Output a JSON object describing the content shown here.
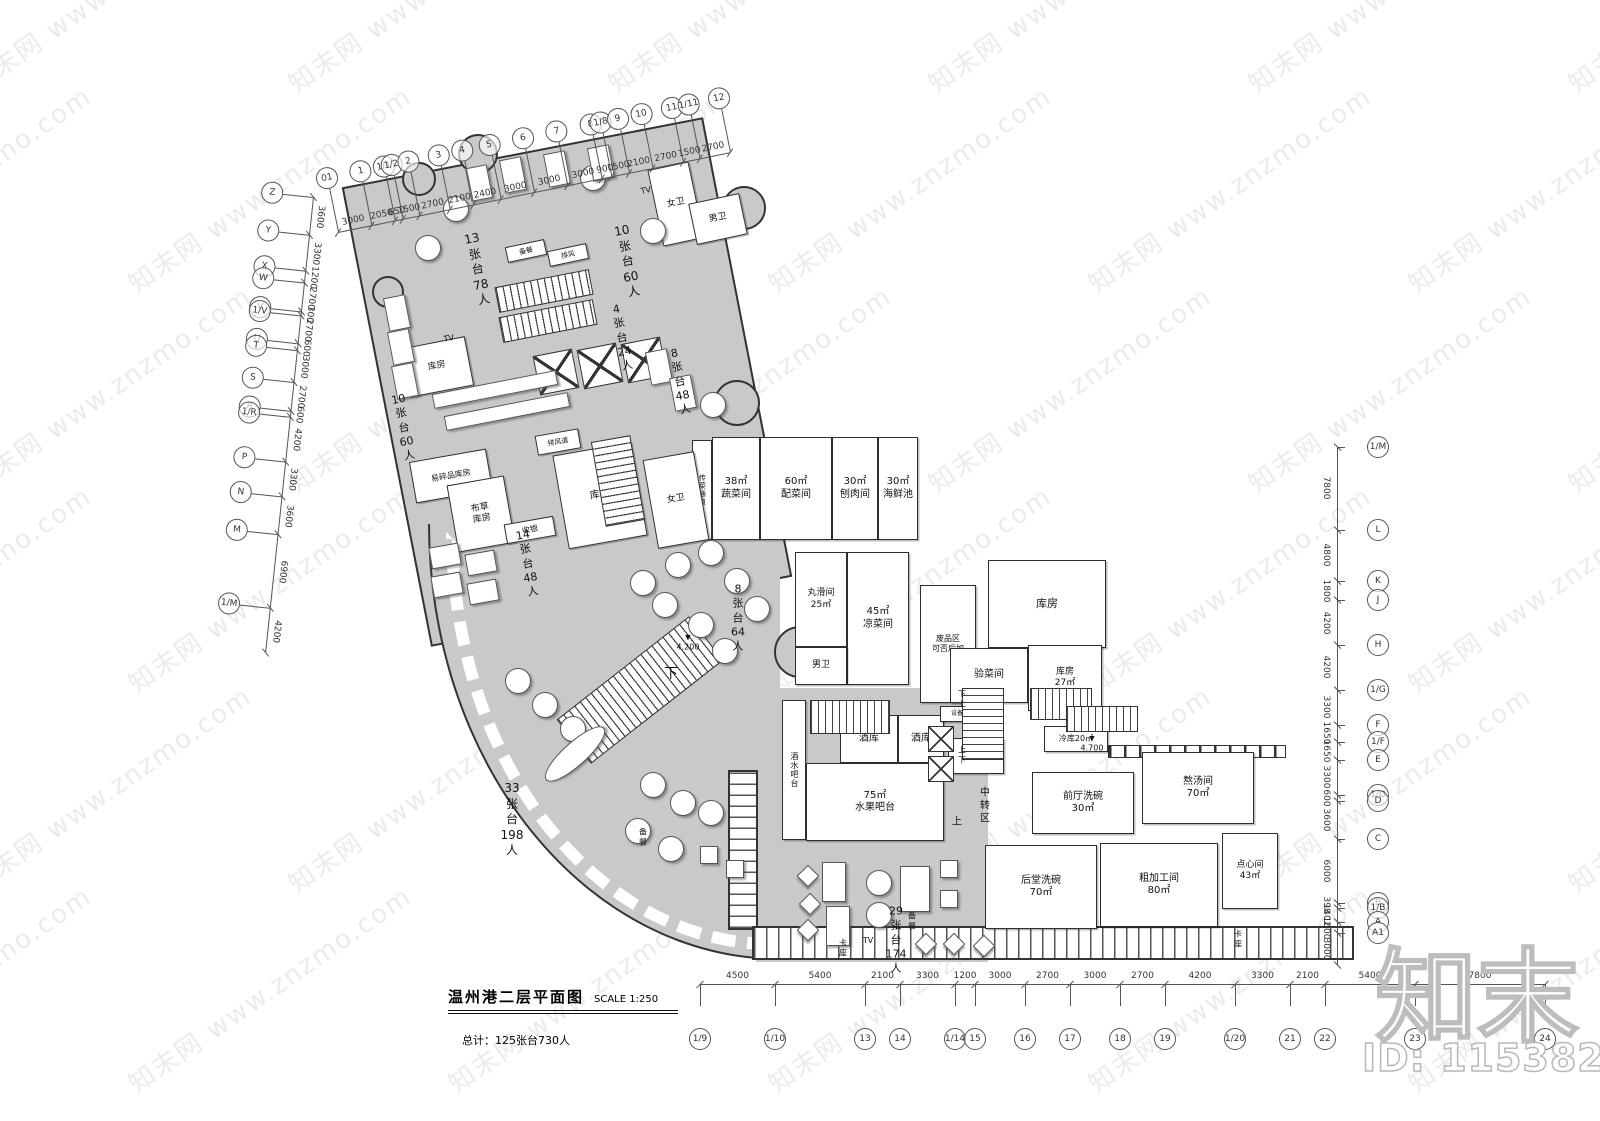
{
  "document": {
    "title": "温州港二层平面图",
    "scale": "SCALE 1:250",
    "total": "总计：125张台730人"
  },
  "brand": {
    "logo": "知末",
    "id_label": "ID: 1153825906",
    "watermark": "知末网 www.znzmo.com"
  },
  "colors": {
    "floor": "#c9c9c9",
    "wall": "#2e2e2e",
    "annotation": "#555555"
  },
  "plan": {
    "rooms": [
      {
        "n": "food-pass-corridor",
        "x": 692,
        "y": 440,
        "w": 20,
        "h": 100,
        "label": "传菜通道",
        "fs": 7,
        "vert": true
      },
      {
        "n": "vegetable-room",
        "x": 712,
        "y": 437,
        "w": 48,
        "h": 103,
        "label": "38㎡\n蔬菜间",
        "fs": 10
      },
      {
        "n": "garnish-room",
        "x": 760,
        "y": 437,
        "w": 72,
        "h": 103,
        "label": "60㎡\n配菜间",
        "fs": 10
      },
      {
        "n": "meat-slicing-room",
        "x": 832,
        "y": 437,
        "w": 46,
        "h": 103,
        "label": "30㎡\n刨肉间",
        "fs": 10
      },
      {
        "n": "seafood-pool",
        "x": 878,
        "y": 437,
        "w": 40,
        "h": 103,
        "label": "30㎡\n海鲜池",
        "fs": 10
      },
      {
        "n": "meatball-room",
        "x": 795,
        "y": 552,
        "w": 52,
        "h": 95,
        "label": "丸滑间\n25㎡",
        "fs": 9
      },
      {
        "n": "cold-dish-room",
        "x": 847,
        "y": 552,
        "w": 62,
        "h": 133,
        "label": "45㎡\n凉菜间",
        "fs": 10
      },
      {
        "n": "mens-toilet-kitchen",
        "x": 795,
        "y": 647,
        "w": 52,
        "h": 38,
        "label": "男卫",
        "fs": 9
      },
      {
        "n": "waste-area",
        "x": 920,
        "y": 585,
        "w": 56,
        "h": 118,
        "label": "废品区\n可否后加",
        "fs": 8
      },
      {
        "n": "storage-upper-right",
        "x": 988,
        "y": 560,
        "w": 118,
        "h": 88,
        "label": "库房",
        "fs": 11
      },
      {
        "n": "goods-check-room",
        "x": 950,
        "y": 648,
        "w": 78,
        "h": 55,
        "label": "验菜间",
        "fs": 10
      },
      {
        "n": "storage-27",
        "x": 1028,
        "y": 645,
        "w": 74,
        "h": 66,
        "label": "库房\n27㎡",
        "fs": 9
      },
      {
        "n": "drinks-bar",
        "x": 782,
        "y": 700,
        "w": 24,
        "h": 140,
        "label": "酒水吧台",
        "fs": 8,
        "vert": true
      },
      {
        "n": "wine-store-1",
        "x": 840,
        "y": 715,
        "w": 58,
        "h": 48,
        "label": "酒库",
        "fs": 10
      },
      {
        "n": "wine-store-2",
        "x": 898,
        "y": 715,
        "w": 46,
        "h": 48,
        "label": "酒库",
        "fs": 10
      },
      {
        "n": "fruit-bar",
        "x": 806,
        "y": 763,
        "w": 138,
        "h": 78,
        "label": "75㎡\n水果吧台",
        "fs": 10
      },
      {
        "n": "engineering-dept",
        "x": 948,
        "y": 738,
        "w": 56,
        "h": 36,
        "label": "工程部",
        "fs": 9
      },
      {
        "n": "equipment-shaft",
        "x": 940,
        "y": 706,
        "w": 52,
        "h": 16,
        "label": "设备管道井",
        "fs": 6
      },
      {
        "n": "cold-store",
        "x": 1044,
        "y": 726,
        "w": 64,
        "h": 26,
        "label": "冷库20㎡",
        "fs": 8
      },
      {
        "n": "front-dishwash",
        "x": 1032,
        "y": 772,
        "w": 102,
        "h": 62,
        "label": "前厅洗碗\n30㎡",
        "fs": 10
      },
      {
        "n": "soup-room",
        "x": 1142,
        "y": 752,
        "w": 112,
        "h": 72,
        "label": "熬汤间\n70㎡",
        "fs": 10
      },
      {
        "n": "back-dishwash",
        "x": 985,
        "y": 845,
        "w": 112,
        "h": 84,
        "label": "后堂洗碗\n70㎡",
        "fs": 10
      },
      {
        "n": "rough-processing",
        "x": 1100,
        "y": 843,
        "w": 118,
        "h": 84,
        "label": "粗加工间\n80㎡",
        "fs": 10
      },
      {
        "n": "pastry-room",
        "x": 1222,
        "y": 833,
        "w": 56,
        "h": 76,
        "label": "点心间\n43㎡",
        "fs": 9
      },
      {
        "n": "storage-upper-left",
        "x": 404,
        "y": 342,
        "w": 66,
        "h": 50,
        "label": "库房",
        "fs": 9,
        "rot": -11
      },
      {
        "n": "fragile-storage",
        "x": 412,
        "y": 455,
        "w": 78,
        "h": 42,
        "label": "易碎品库房",
        "fs": 8,
        "rot": -10
      },
      {
        "n": "linen-storage",
        "x": 452,
        "y": 480,
        "w": 58,
        "h": 68,
        "label": "布草\n库房",
        "fs": 9,
        "rot": -10
      },
      {
        "n": "exhaust-duct",
        "x": 536,
        "y": 432,
        "w": 44,
        "h": 20,
        "label": "排风道",
        "fs": 7,
        "rot": -10
      },
      {
        "n": "storage-center",
        "x": 560,
        "y": 448,
        "w": 80,
        "h": 95,
        "label": "库房",
        "fs": 10,
        "rot": -10
      },
      {
        "n": "womens-toilet-center",
        "x": 650,
        "y": 455,
        "w": 52,
        "h": 90,
        "label": "女卫",
        "fs": 9,
        "rot": -10
      },
      {
        "n": "womens-toilet-top",
        "x": 655,
        "y": 165,
        "w": 42,
        "h": 78,
        "label": "女卫",
        "fs": 9,
        "rot": -12
      },
      {
        "n": "mens-toilet-top",
        "x": 692,
        "y": 198,
        "w": 52,
        "h": 42,
        "label": "男卫",
        "fs": 9,
        "rot": -12
      },
      {
        "n": "cashier",
        "x": 505,
        "y": 520,
        "w": 50,
        "h": 20,
        "label": "收银",
        "fs": 8,
        "rot": -10
      },
      {
        "n": "pantry-top",
        "x": 506,
        "y": 243,
        "w": 40,
        "h": 16,
        "label": "备餐",
        "fs": 7,
        "rot": -12
      },
      {
        "n": "vent-top",
        "x": 548,
        "y": 247,
        "w": 40,
        "h": 16,
        "label": "排风",
        "fs": 7,
        "rot": -12
      }
    ],
    "labels": [
      {
        "x": 478,
        "y": 270,
        "t": "13张台\n78人",
        "fs": 12,
        "r": -11
      },
      {
        "x": 628,
        "y": 262,
        "t": "10张台\n60人",
        "fs": 12,
        "r": -11
      },
      {
        "x": 622,
        "y": 338,
        "t": "4张台\n24人",
        "fs": 11,
        "r": -11
      },
      {
        "x": 680,
        "y": 382,
        "t": "8张台\n48人",
        "fs": 11,
        "r": -11
      },
      {
        "x": 404,
        "y": 428,
        "t": "10张台\n60人",
        "fs": 11,
        "r": -11
      },
      {
        "x": 528,
        "y": 564,
        "t": "14张台\n48人",
        "fs": 11,
        "r": -10
      },
      {
        "x": 738,
        "y": 618,
        "t": "8张台\n64人",
        "fs": 11
      },
      {
        "x": 512,
        "y": 820,
        "t": "33张台\n198人",
        "fs": 12
      },
      {
        "x": 896,
        "y": 940,
        "t": "29张台\n174人",
        "fs": 11
      },
      {
        "x": 985,
        "y": 806,
        "t": "中转区",
        "fs": 10
      },
      {
        "x": 643,
        "y": 838,
        "t": "备餐",
        "fs": 8
      },
      {
        "x": 912,
        "y": 922,
        "t": "备餐",
        "fs": 8
      },
      {
        "x": 843,
        "y": 949,
        "t": "卡座",
        "fs": 8
      },
      {
        "x": 1238,
        "y": 940,
        "t": "卡座",
        "fs": 8
      },
      {
        "x": 449,
        "y": 339,
        "t": "TV",
        "fs": 8,
        "r": -11
      },
      {
        "x": 646,
        "y": 191,
        "t": "TV",
        "fs": 8,
        "r": -11
      },
      {
        "x": 868,
        "y": 941,
        "t": "TV",
        "fs": 8
      },
      {
        "x": 671,
        "y": 674,
        "t": "下",
        "fs": 14
      },
      {
        "x": 962,
        "y": 700,
        "t": "下  上",
        "fs": 8
      },
      {
        "x": 962,
        "y": 756,
        "t": "上  下",
        "fs": 8
      },
      {
        "x": 957,
        "y": 822,
        "t": "上",
        "fs": 10
      },
      {
        "x": 688,
        "y": 643,
        "t": "4.200",
        "fs": 8,
        "lvl": true
      },
      {
        "x": 1092,
        "y": 744,
        "t": "4.700",
        "fs": 8,
        "lvl": true
      }
    ],
    "stairs": [
      {
        "x": 496,
        "y": 278,
        "w": 96,
        "h": 26,
        "r": -11
      },
      {
        "x": 500,
        "y": 308,
        "w": 96,
        "h": 26,
        "r": -11
      },
      {
        "x": 598,
        "y": 438,
        "w": 40,
        "h": 86,
        "r": -10,
        "v": true
      },
      {
        "x": 556,
        "y": 662,
        "w": 168,
        "h": 56,
        "r": -38
      },
      {
        "x": 810,
        "y": 700,
        "w": 80,
        "h": 34
      },
      {
        "x": 962,
        "y": 688,
        "w": 42,
        "h": 72,
        "v": true
      },
      {
        "x": 1030,
        "y": 688,
        "w": 62,
        "h": 32
      },
      {
        "x": 1066,
        "y": 706,
        "w": 72,
        "h": 26
      }
    ],
    "elevators": [
      {
        "x": 536,
        "y": 352,
        "s": 40,
        "r": -11
      },
      {
        "x": 580,
        "y": 346,
        "s": 40,
        "r": -11
      },
      {
        "x": 624,
        "y": 340,
        "s": 40,
        "r": -11
      },
      {
        "x": 928,
        "y": 726,
        "s": 26
      },
      {
        "x": 928,
        "y": 756,
        "s": 26
      }
    ],
    "bumps": [
      {
        "x": 458,
        "y": 134,
        "d": 40
      },
      {
        "x": 722,
        "y": 186,
        "d": 44
      },
      {
        "x": 372,
        "y": 276,
        "d": 32
      },
      {
        "x": 714,
        "y": 380,
        "d": 46
      },
      {
        "x": 774,
        "y": 626,
        "d": 52
      },
      {
        "x": 402,
        "y": 162,
        "d": 34
      }
    ],
    "furniture": [
      {
        "t": "c",
        "x": 443,
        "y": 196
      },
      {
        "t": "c",
        "x": 415,
        "y": 235
      },
      {
        "t": "c",
        "x": 580,
        "y": 165
      },
      {
        "t": "c",
        "x": 640,
        "y": 218
      },
      {
        "t": "c",
        "x": 700,
        "y": 392
      },
      {
        "t": "c",
        "x": 630,
        "y": 570
      },
      {
        "t": "c",
        "x": 665,
        "y": 552
      },
      {
        "t": "c",
        "x": 698,
        "y": 540
      },
      {
        "t": "c",
        "x": 724,
        "y": 568
      },
      {
        "t": "c",
        "x": 744,
        "y": 596
      },
      {
        "t": "c",
        "x": 688,
        "y": 612
      },
      {
        "t": "c",
        "x": 652,
        "y": 592
      },
      {
        "t": "c",
        "x": 712,
        "y": 638
      },
      {
        "t": "c",
        "x": 505,
        "y": 668
      },
      {
        "t": "c",
        "x": 532,
        "y": 692
      },
      {
        "t": "c",
        "x": 560,
        "y": 716
      },
      {
        "t": "c",
        "x": 640,
        "y": 772
      },
      {
        "t": "c",
        "x": 670,
        "y": 790
      },
      {
        "t": "c",
        "x": 698,
        "y": 800
      },
      {
        "t": "c",
        "x": 625,
        "y": 818
      },
      {
        "t": "c",
        "x": 658,
        "y": 836
      },
      {
        "t": "c",
        "x": 866,
        "y": 870
      },
      {
        "t": "c",
        "x": 866,
        "y": 902
      },
      {
        "t": "q",
        "x": 940,
        "y": 860
      },
      {
        "t": "q",
        "x": 940,
        "y": 890
      },
      {
        "t": "q",
        "x": 700,
        "y": 846
      },
      {
        "t": "q",
        "x": 726,
        "y": 860
      },
      {
        "t": "d",
        "x": 800,
        "y": 868
      },
      {
        "t": "d",
        "x": 802,
        "y": 896
      },
      {
        "t": "d",
        "x": 800,
        "y": 922
      },
      {
        "t": "d",
        "x": 918,
        "y": 936
      },
      {
        "t": "d",
        "x": 946,
        "y": 936
      },
      {
        "t": "d",
        "x": 976,
        "y": 938
      },
      {
        "t": "r",
        "x": 468,
        "y": 166,
        "r": -11
      },
      {
        "t": "r",
        "x": 502,
        "y": 158,
        "r": -11
      },
      {
        "t": "r",
        "x": 546,
        "y": 152,
        "r": -11
      },
      {
        "t": "r",
        "x": 590,
        "y": 146,
        "r": -11
      },
      {
        "t": "r",
        "x": 648,
        "y": 350,
        "r": -11
      },
      {
        "t": "r",
        "x": 672,
        "y": 376,
        "r": -11
      },
      {
        "t": "r",
        "x": 386,
        "y": 296,
        "r": -11
      },
      {
        "t": "r",
        "x": 390,
        "y": 330,
        "r": -11
      },
      {
        "t": "r",
        "x": 394,
        "y": 364,
        "r": -11
      },
      {
        "t": "r",
        "x": 430,
        "y": 545,
        "w": 30,
        "h": 22,
        "r": -10
      },
      {
        "t": "r",
        "x": 466,
        "y": 552,
        "w": 30,
        "h": 22,
        "r": -10
      },
      {
        "t": "r",
        "x": 432,
        "y": 574,
        "w": 30,
        "h": 22,
        "r": -10
      },
      {
        "t": "r",
        "x": 468,
        "y": 581,
        "w": 30,
        "h": 22,
        "r": -10
      },
      {
        "t": "r",
        "x": 822,
        "y": 862,
        "w": 24,
        "h": 40
      },
      {
        "t": "r",
        "x": 826,
        "y": 906,
        "w": 24,
        "h": 40
      },
      {
        "t": "r",
        "x": 900,
        "y": 866,
        "w": 30,
        "h": 46
      },
      {
        "t": "k",
        "x": 432,
        "y": 382,
        "w": 126,
        "h": 15,
        "r": -11
      },
      {
        "t": "k",
        "x": 444,
        "y": 404,
        "w": 126,
        "h": 15,
        "r": -11
      },
      {
        "t": "o",
        "x": 536,
        "y": 742,
        "w": 78,
        "h": 24,
        "r": -42
      }
    ]
  },
  "grids": {
    "top": {
      "ori": "h",
      "x": 338,
      "y": 232,
      "len": 400,
      "rot": -11.5,
      "numSide": -1,
      "bubOff": -66,
      "dims": [
        3000,
        2050,
        650,
        1500,
        2700,
        2100,
        2400,
        3000,
        3000,
        3000,
        900,
        1500,
        2100,
        2700,
        1500,
        2700
      ],
      "bubbles": [
        "01",
        "1",
        "1/1",
        "1/2",
        "2",
        "3",
        "4",
        "5",
        "6",
        "7",
        "8",
        "1/8",
        "9",
        "10",
        "11",
        "1/11",
        "12"
      ]
    },
    "left": {
      "ori": "v",
      "x": 313,
      "y": 197,
      "len": 458,
      "rot": 6,
      "numSide": 1,
      "bubOff": -52,
      "dims": [
        3600,
        3300,
        1200,
        2700,
        300,
        2700,
        600,
        3000,
        2700,
        600,
        4200,
        3300,
        3600,
        6900,
        4200
      ],
      "bubbles": [
        "Z",
        "Y",
        "X",
        "W",
        "V",
        "1/V",
        "U",
        "T",
        "S",
        "R",
        "1/R",
        "P",
        "N",
        "M",
        "1/M"
      ]
    },
    "right": {
      "ori": "v",
      "x": 1337,
      "y": 447,
      "len": 518,
      "rot": 0,
      "numSide": -1,
      "bubOff": 30,
      "dims": [
        7800,
        4800,
        1800,
        4200,
        4200,
        3300,
        1650,
        1650,
        3300,
        600,
        3600,
        6000,
        398,
        1402,
        1000,
        3000
      ],
      "bubbles": [
        "1/M",
        "L",
        "K",
        "J",
        "H",
        "1/G",
        "F",
        "1/F",
        "E",
        "1/D",
        "D",
        "C",
        "B",
        "1/B",
        "A",
        "A1"
      ]
    },
    "bottom": {
      "ori": "h",
      "x": 700,
      "y": 984,
      "len": 845,
      "rot": 0,
      "numSide": -1,
      "bubOff": 44,
      "dims": [
        4500,
        5400,
        2100,
        3300,
        1200,
        3000,
        2700,
        3000,
        2700,
        4200,
        3300,
        2100,
        5400,
        7800
      ],
      "bubbles": [
        "1/9",
        "1/10",
        "13",
        "14",
        "1/14",
        "15",
        "16",
        "17",
        "18",
        "19",
        "1/20",
        "21",
        "22",
        "23",
        "24"
      ]
    }
  }
}
